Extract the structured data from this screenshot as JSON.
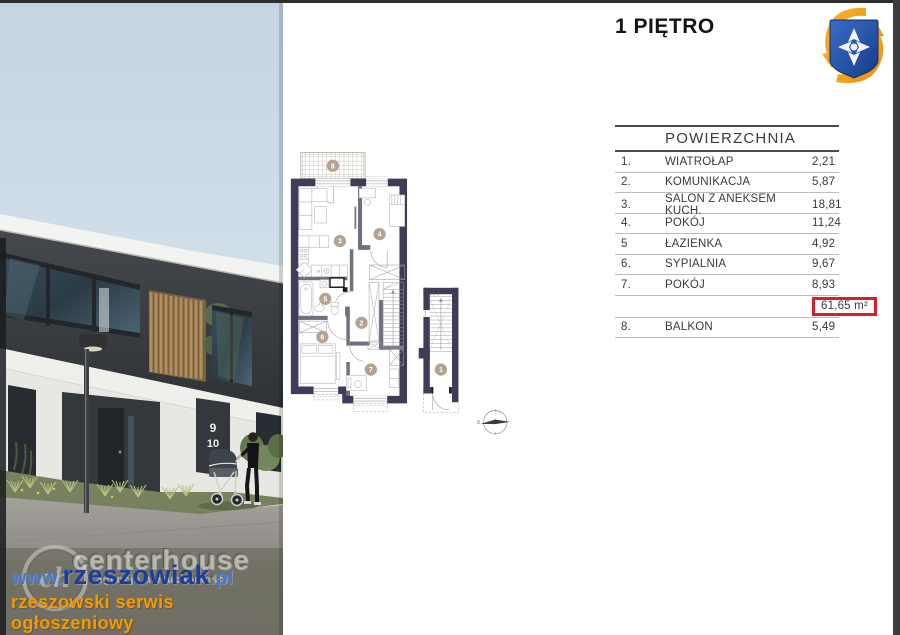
{
  "header": {
    "title": "1 PIĘTRO"
  },
  "logo": {
    "name": "herb-rzeszowa",
    "shield_blue": "#2653a6",
    "arrow_orange": "#f59b00"
  },
  "area_table": {
    "title": "POWIERZCHNIA",
    "unit_total": "61,65 m²",
    "total_after_index": 6,
    "rows": [
      {
        "no": "1.",
        "name": "WIATROŁAP",
        "area": "2,21"
      },
      {
        "no": "2.",
        "name": "KOMUNIKACJA",
        "area": "5,87"
      },
      {
        "no": "3.",
        "name": "SALON Z ANEKSEM KUCH.",
        "area": "18,81"
      },
      {
        "no": "4.",
        "name": "POKÓJ",
        "area": "11,24"
      },
      {
        "no": "5",
        "name": "ŁAZIENKA",
        "area": "4,92"
      },
      {
        "no": "6.",
        "name": "SYPIALNIA",
        "area": "9,67"
      },
      {
        "no": "7.",
        "name": "POKÓJ",
        "area": "8,93"
      },
      {
        "no": "8.",
        "name": "BALKON",
        "area": "5,49"
      }
    ]
  },
  "plan": {
    "room_badges": [
      "1",
      "2",
      "3",
      "4",
      "5",
      "6",
      "7",
      "8"
    ],
    "kitchen_label": "ZM",
    "compass_label": "N",
    "colors": {
      "outer_wall": "#3d3d57",
      "partition": "#71717d",
      "badge": "#b4a292",
      "highlight": "#d5202b"
    }
  },
  "photo": {
    "house_numbers": [
      "9",
      "10"
    ],
    "watermark": {
      "brand": "centerhouse",
      "brand_sub": "agencja nieruchomości",
      "url_prefix": "www.",
      "url_domain": "rzeszowiak",
      "url_tld": ".pl",
      "tagline": "rzeszowski serwis ogłoszeniowy"
    }
  }
}
